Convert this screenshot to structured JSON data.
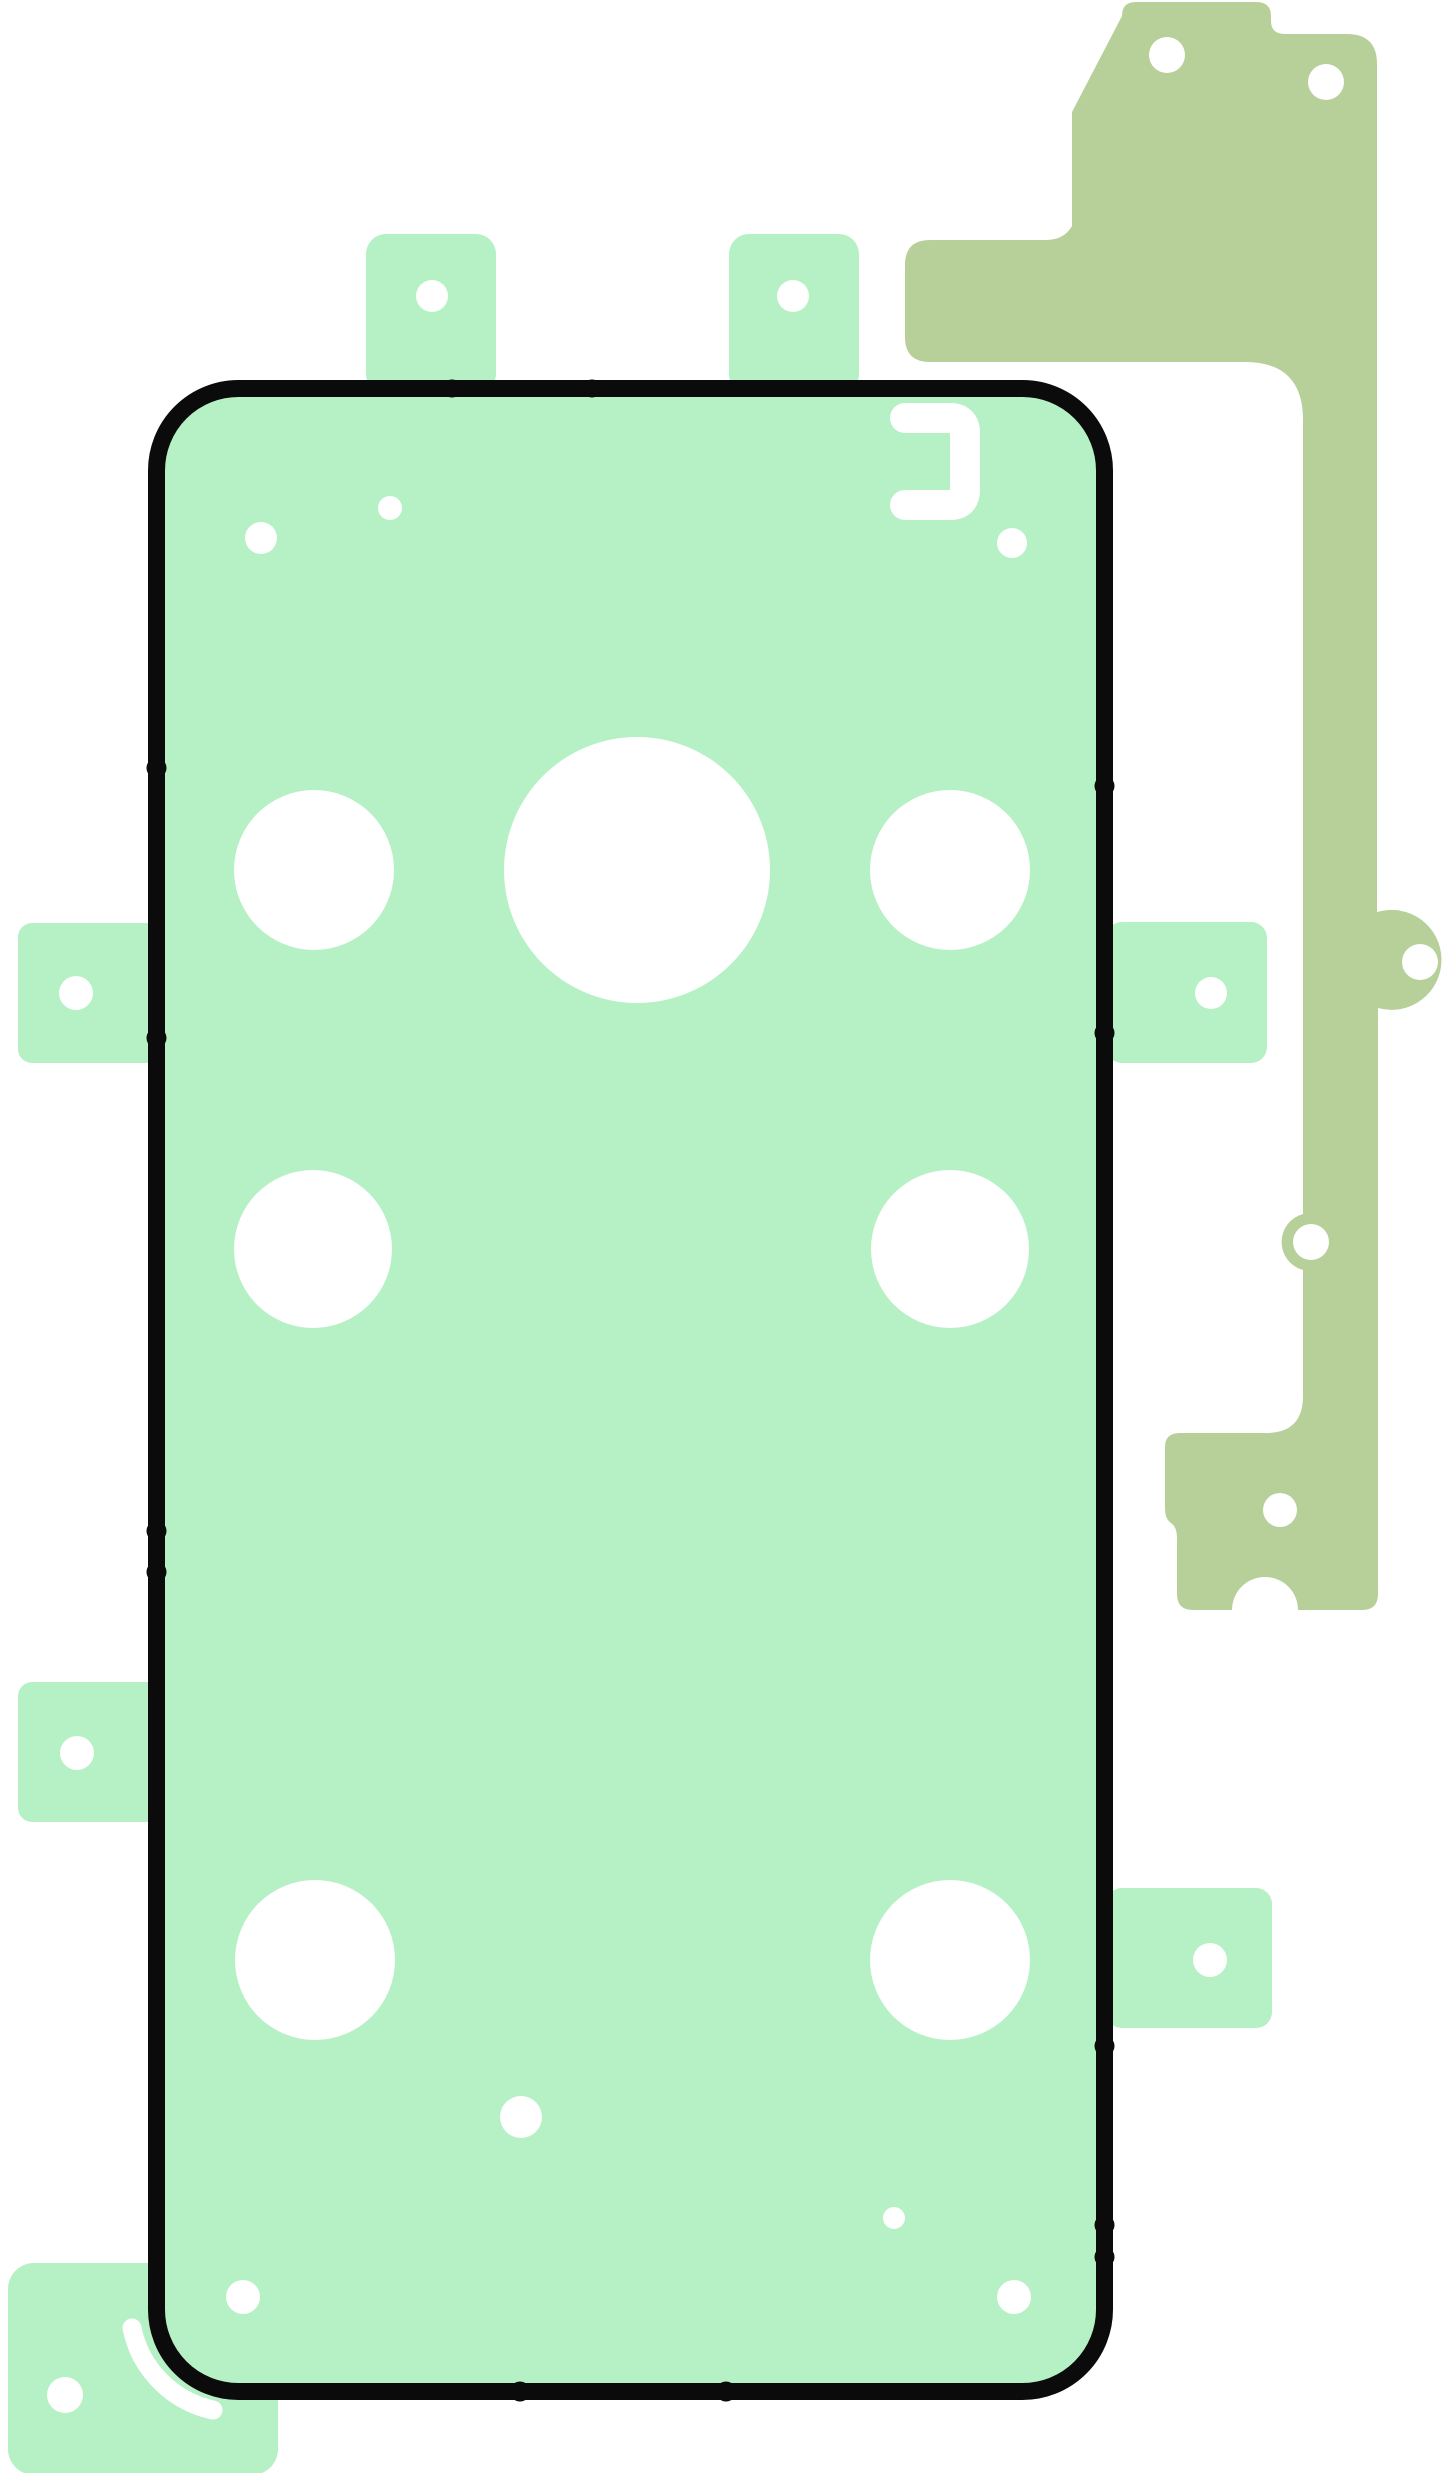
{
  "image": {
    "kind": "adhesive-tape-set-diagram",
    "description": "Smartphone rear-cover adhesive foil set: main mint gasket with black outline and camera cutouts, peel tabs, sage side strip, bottom-left corner piece",
    "width": 1445,
    "height": 2473
  },
  "colors": {
    "background": "#ffffff",
    "adhesive_mint": "#b6f0c5",
    "adhesive_sage": "#b7d099",
    "outline_black": "#0b0b0b",
    "cutout_white": "#ffffff"
  },
  "svg_elements": [
    {
      "tag": "rect",
      "name": "corner-piece",
      "attrs": {
        "x": 8,
        "y": 2263,
        "width": 270,
        "height": 212,
        "rx": 26,
        "fill": "#b6f0c5"
      }
    },
    {
      "tag": "circle",
      "name": "corner-piece-hole",
      "attrs": {
        "cx": 65,
        "cy": 2395,
        "r": 18,
        "fill": "#ffffff"
      }
    },
    {
      "tag": "path",
      "name": "corner-piece-slot",
      "attrs": {
        "d": "M 132 2328 A 105 105 0 0 0 213 2410",
        "fill": "none",
        "stroke": "#ffffff",
        "stroke-width": 19,
        "stroke-linecap": "round"
      }
    },
    {
      "tag": "path",
      "name": "side-strip-piece",
      "attrs": {
        "d": "M 1122 16 Q 1122 2 1136 2 L 1256 2 Q 1271 2 1271 16 L 1271 21 Q 1271 34 1285 34 L 1347 34 Q 1377 34 1377 64 L 1377 912 A 50 50 0 1 1 1378 1008 L 1378 1594 Q 1378 1610 1362 1610 L 1298 1610 A 33 33 0 0 0 1232 1610 L 1193 1610 Q 1177 1610 1177 1594 L 1177 1538 Q 1177 1527 1171 1523 Q 1165 1519 1165 1508 L 1165 1447 Q 1165 1433 1180 1433 L 1266 1433 Q 1303 1433 1303 1396 L 1303 1270 A 29 29 0 0 1 1303 1214 L 1303 420 Q 1303 362 1245 362 L 930 362 Q 905 362 905 337 L 905 265 Q 905 240 930 240 L 1046 240 Q 1064 240 1072 226 L 1072 112 Z",
        "fill": "#b7d099"
      }
    },
    {
      "tag": "circle",
      "name": "side-strip-hole-top-left",
      "attrs": {
        "cx": 1167,
        "cy": 55,
        "r": 18,
        "fill": "#ffffff"
      }
    },
    {
      "tag": "circle",
      "name": "side-strip-hole-top-right",
      "attrs": {
        "cx": 1326,
        "cy": 82,
        "r": 18,
        "fill": "#ffffff"
      }
    },
    {
      "tag": "circle",
      "name": "side-strip-hole-right-bump",
      "attrs": {
        "cx": 1420,
        "cy": 962,
        "r": 18,
        "fill": "#ffffff"
      }
    },
    {
      "tag": "circle",
      "name": "side-strip-hole-left-bump",
      "attrs": {
        "cx": 1311,
        "cy": 1242,
        "r": 18,
        "fill": "#ffffff"
      }
    },
    {
      "tag": "circle",
      "name": "side-strip-hole-foot",
      "attrs": {
        "cx": 1280,
        "cy": 1510,
        "r": 17,
        "fill": "#ffffff"
      }
    },
    {
      "tag": "rect",
      "name": "tab-top-left",
      "attrs": {
        "x": 366,
        "y": 234,
        "width": 130,
        "height": 160,
        "rx": 20,
        "fill": "#b6f0c5"
      }
    },
    {
      "tag": "rect",
      "name": "tab-top-right",
      "attrs": {
        "x": 729,
        "y": 234,
        "width": 130,
        "height": 160,
        "rx": 20,
        "fill": "#b6f0c5"
      }
    },
    {
      "tag": "rect",
      "name": "tab-left-upper",
      "attrs": {
        "x": 18,
        "y": 923,
        "width": 142,
        "height": 140,
        "rx": 14,
        "fill": "#b6f0c5"
      }
    },
    {
      "tag": "rect",
      "name": "tab-left-lower",
      "attrs": {
        "x": 18,
        "y": 1682,
        "width": 142,
        "height": 140,
        "rx": 14,
        "fill": "#b6f0c5"
      }
    },
    {
      "tag": "rect",
      "name": "tab-right-upper",
      "attrs": {
        "x": 1106,
        "y": 922,
        "width": 161,
        "height": 141,
        "rx": 16,
        "fill": "#b6f0c5"
      }
    },
    {
      "tag": "rect",
      "name": "tab-right-lower",
      "attrs": {
        "x": 1106,
        "y": 1888,
        "width": 166,
        "height": 140,
        "rx": 16,
        "fill": "#b6f0c5"
      }
    },
    {
      "tag": "circle",
      "name": "tab-top-left-hole",
      "attrs": {
        "cx": 432,
        "cy": 296,
        "r": 16,
        "fill": "#ffffff"
      }
    },
    {
      "tag": "circle",
      "name": "tab-top-right-hole",
      "attrs": {
        "cx": 793,
        "cy": 296,
        "r": 16,
        "fill": "#ffffff"
      }
    },
    {
      "tag": "circle",
      "name": "tab-left-upper-hole",
      "attrs": {
        "cx": 76,
        "cy": 993,
        "r": 17,
        "fill": "#ffffff"
      }
    },
    {
      "tag": "circle",
      "name": "tab-left-lower-hole",
      "attrs": {
        "cx": 77,
        "cy": 1753,
        "r": 17,
        "fill": "#ffffff"
      }
    },
    {
      "tag": "circle",
      "name": "tab-right-upper-hole",
      "attrs": {
        "cx": 1211,
        "cy": 993,
        "r": 16,
        "fill": "#ffffff"
      }
    },
    {
      "tag": "circle",
      "name": "tab-right-lower-hole",
      "attrs": {
        "cx": 1210,
        "cy": 1960,
        "r": 17,
        "fill": "#ffffff"
      }
    },
    {
      "tag": "rect",
      "name": "main-gasket-outline",
      "attrs": {
        "x": 156.5,
        "y": 388.5,
        "width": 948,
        "height": 2003,
        "rx": 82,
        "fill": "#b6f0c5",
        "stroke": "#0b0b0b",
        "stroke-width": 17
      }
    },
    {
      "tag": "circle",
      "name": "edge-mark-left-1",
      "attrs": {
        "cx": 156.5,
        "cy": 768,
        "r": 10,
        "fill": "#0b0b0b"
      }
    },
    {
      "tag": "circle",
      "name": "edge-mark-left-2",
      "attrs": {
        "cx": 156.5,
        "cy": 1038,
        "r": 10,
        "fill": "#0b0b0b"
      }
    },
    {
      "tag": "circle",
      "name": "edge-mark-left-3",
      "attrs": {
        "cx": 156.5,
        "cy": 1531,
        "r": 10,
        "fill": "#0b0b0b"
      }
    },
    {
      "tag": "circle",
      "name": "edge-mark-left-4",
      "attrs": {
        "cx": 156.5,
        "cy": 1572,
        "r": 10,
        "fill": "#0b0b0b"
      }
    },
    {
      "tag": "circle",
      "name": "edge-mark-right-1",
      "attrs": {
        "cx": 1104.5,
        "cy": 786,
        "r": 10,
        "fill": "#0b0b0b"
      }
    },
    {
      "tag": "circle",
      "name": "edge-mark-right-2",
      "attrs": {
        "cx": 1104.5,
        "cy": 1033,
        "r": 10,
        "fill": "#0b0b0b"
      }
    },
    {
      "tag": "circle",
      "name": "edge-mark-right-3",
      "attrs": {
        "cx": 1104.5,
        "cy": 2046,
        "r": 10,
        "fill": "#0b0b0b"
      }
    },
    {
      "tag": "circle",
      "name": "edge-mark-right-4",
      "attrs": {
        "cx": 1104.5,
        "cy": 2225,
        "r": 10,
        "fill": "#0b0b0b"
      }
    },
    {
      "tag": "circle",
      "name": "edge-mark-right-5",
      "attrs": {
        "cx": 1104.5,
        "cy": 2257,
        "r": 10,
        "fill": "#0b0b0b"
      }
    },
    {
      "tag": "circle",
      "name": "edge-mark-bottom-1",
      "attrs": {
        "cx": 520,
        "cy": 2391.5,
        "r": 10,
        "fill": "#0b0b0b"
      }
    },
    {
      "tag": "circle",
      "name": "edge-mark-bottom-2",
      "attrs": {
        "cx": 726,
        "cy": 2391.5,
        "r": 10,
        "fill": "#0b0b0b"
      }
    },
    {
      "tag": "circle",
      "name": "edge-mark-top-1",
      "attrs": {
        "cx": 452,
        "cy": 388.5,
        "r": 9,
        "fill": "#0b0b0b"
      }
    },
    {
      "tag": "circle",
      "name": "edge-mark-top-2",
      "attrs": {
        "cx": 592,
        "cy": 388.5,
        "r": 9,
        "fill": "#0b0b0b"
      }
    },
    {
      "tag": "circle",
      "name": "camera-cutout-row1-left",
      "attrs": {
        "cx": 314,
        "cy": 870,
        "r": 80,
        "fill": "#ffffff"
      }
    },
    {
      "tag": "circle",
      "name": "camera-cutout-row1-center",
      "attrs": {
        "cx": 637,
        "cy": 870,
        "r": 133,
        "fill": "#ffffff"
      }
    },
    {
      "tag": "circle",
      "name": "camera-cutout-row1-right",
      "attrs": {
        "cx": 950,
        "cy": 870,
        "r": 80,
        "fill": "#ffffff"
      }
    },
    {
      "tag": "circle",
      "name": "camera-cutout-row2-left",
      "attrs": {
        "cx": 313,
        "cy": 1249,
        "r": 79,
        "fill": "#ffffff"
      }
    },
    {
      "tag": "circle",
      "name": "camera-cutout-row2-right",
      "attrs": {
        "cx": 950,
        "cy": 1249,
        "r": 79,
        "fill": "#ffffff"
      }
    },
    {
      "tag": "circle",
      "name": "camera-cutout-row3-left",
      "attrs": {
        "cx": 315,
        "cy": 1960,
        "r": 80,
        "fill": "#ffffff"
      }
    },
    {
      "tag": "circle",
      "name": "camera-cutout-row3-right",
      "attrs": {
        "cx": 950,
        "cy": 1960,
        "r": 80,
        "fill": "#ffffff"
      }
    },
    {
      "tag": "path",
      "name": "bracket-cutout",
      "attrs": {
        "d": "M 905 418 L 950 418 Q 965 418 965 433 L 965 490 Q 965 505 950 505 L 905 505",
        "fill": "none",
        "stroke": "#ffffff",
        "stroke-width": 30,
        "stroke-linecap": "round",
        "stroke-linejoin": "round"
      }
    },
    {
      "tag": "circle",
      "name": "dot-cutout-near-bracket",
      "attrs": {
        "cx": 1012,
        "cy": 543,
        "r": 15,
        "fill": "#ffffff"
      }
    },
    {
      "tag": "circle",
      "name": "dot-cutout-top-left",
      "attrs": {
        "cx": 261,
        "cy": 538,
        "r": 16,
        "fill": "#ffffff"
      }
    },
    {
      "tag": "circle",
      "name": "dot-cutout-top-center",
      "attrs": {
        "cx": 390,
        "cy": 508,
        "r": 12,
        "fill": "#ffffff"
      }
    },
    {
      "tag": "circle",
      "name": "dot-cutout-bottom-center",
      "attrs": {
        "cx": 521,
        "cy": 2117,
        "r": 21,
        "fill": "#ffffff"
      }
    },
    {
      "tag": "circle",
      "name": "dot-cutout-bottom-small",
      "attrs": {
        "cx": 894,
        "cy": 2218,
        "r": 11,
        "fill": "#ffffff"
      }
    },
    {
      "tag": "circle",
      "name": "dot-cutout-bottom-left",
      "attrs": {
        "cx": 243,
        "cy": 2297,
        "r": 17,
        "fill": "#ffffff"
      }
    },
    {
      "tag": "circle",
      "name": "dot-cutout-bottom-right",
      "attrs": {
        "cx": 1014,
        "cy": 2297,
        "r": 17,
        "fill": "#ffffff"
      }
    }
  ]
}
